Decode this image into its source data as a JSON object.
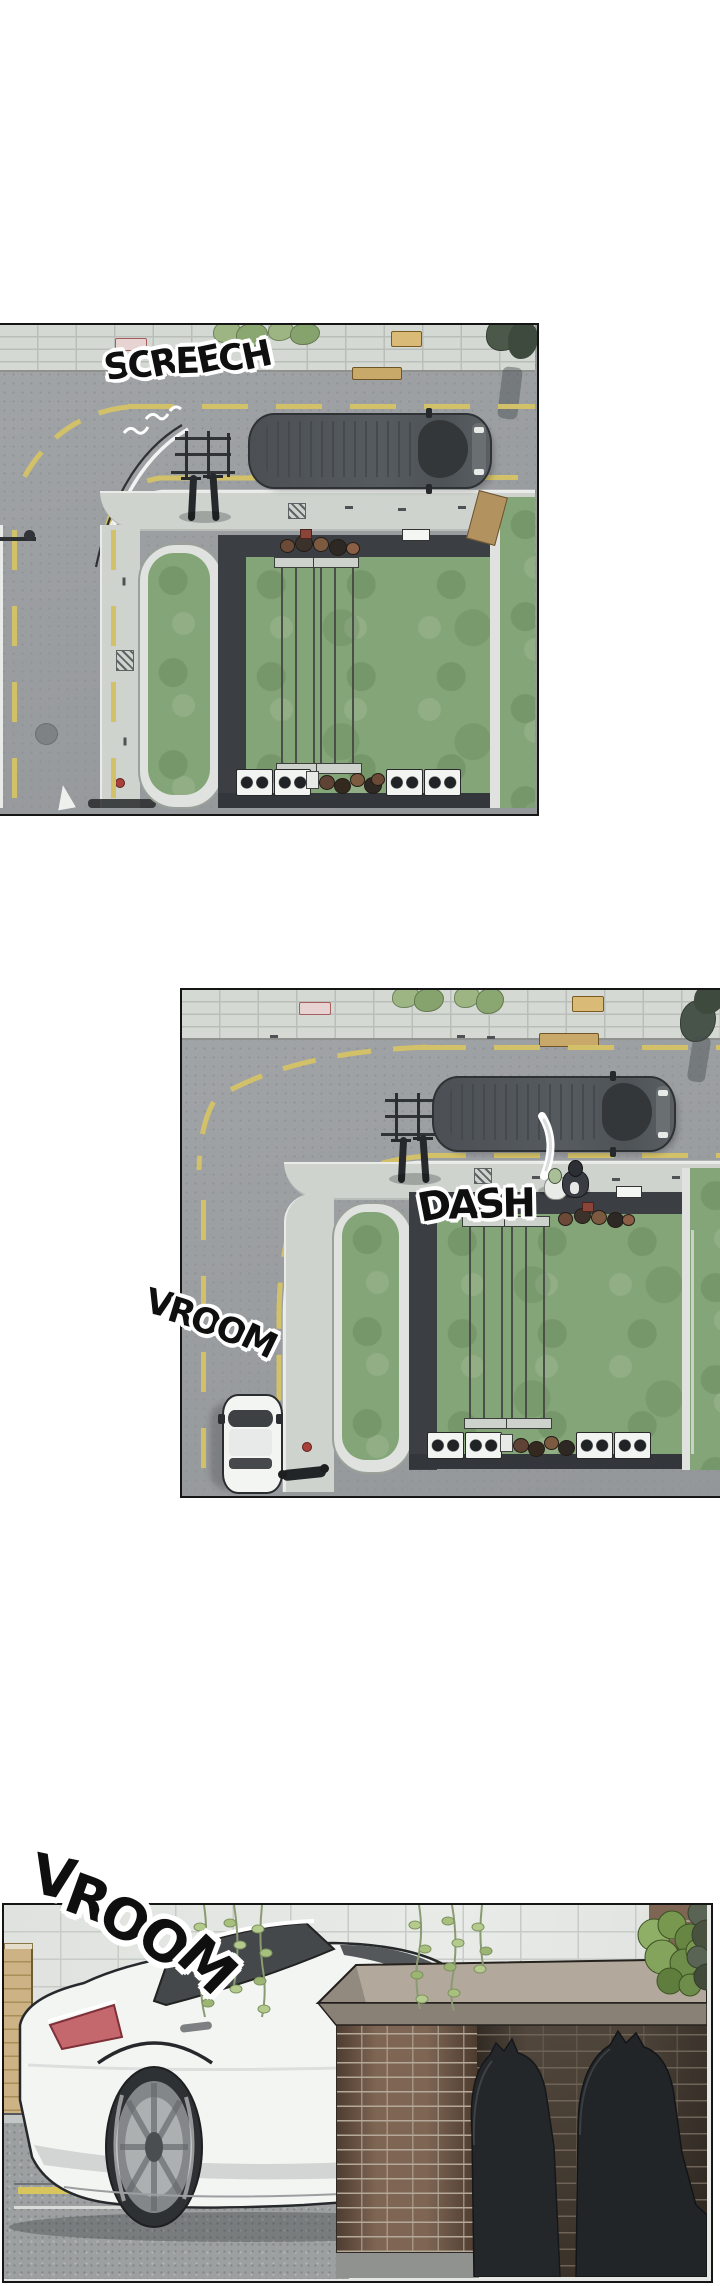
{
  "page": {
    "type": "webtoon-comic-page",
    "background": "#ffffff",
    "panel_count": 3
  },
  "sfx": {
    "screech": "SCREECH",
    "dash": "DASH",
    "vroom_street": "VROOM",
    "vroom_wall": "VROOM"
  },
  "palette": {
    "road": "#9b9ea1",
    "sidewalk": "#ced3ce",
    "lane_yellow": "#d3c169",
    "courtyard_green": "#84a577",
    "courtyard_frame": "#3b3f43",
    "van_body": "#53585c",
    "car_white": "#f3f5f3",
    "cinder_wall": "#e4e7e3",
    "brick_wall": "#7f6654",
    "silhouette": "#24272a",
    "taillight": "#c4686e",
    "ivy_leaf": "#b5cb8e",
    "sfx_ink": "#0f0f0f",
    "sfx_outline": "#ffffff",
    "panel_border": "#151515"
  }
}
